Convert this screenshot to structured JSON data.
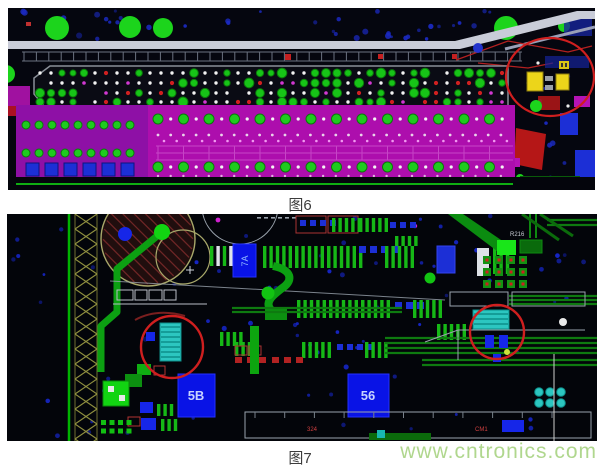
{
  "figure6": {
    "caption": "图6"
  },
  "figure7": {
    "caption": "图7",
    "labels": {
      "ic_7a": "7A",
      "ic_5b": "5B",
      "ic_56": "56",
      "ref_r216": "R216",
      "ref_324": "324",
      "ref_cm1": "CM1"
    }
  },
  "watermark": {
    "text": "www.cntronics.com",
    "color": "#b0d78e"
  },
  "colors": {
    "annotation_red": "#cf1f1f",
    "pad_green": "#16b816",
    "pad_green_bright": "#1cd41c",
    "plane_magenta": "#ad0ead",
    "component_blue": "#1c2fd6",
    "ic_blue": "#0913e6",
    "via_blue": "#1b2ac2",
    "highlight_cyan": "#2cc6c0",
    "component_yellow": "#ecd51a",
    "hatch_olive": "#8f8f3f",
    "silk_white": "#c9ccd8",
    "board_black": "#04060c"
  }
}
